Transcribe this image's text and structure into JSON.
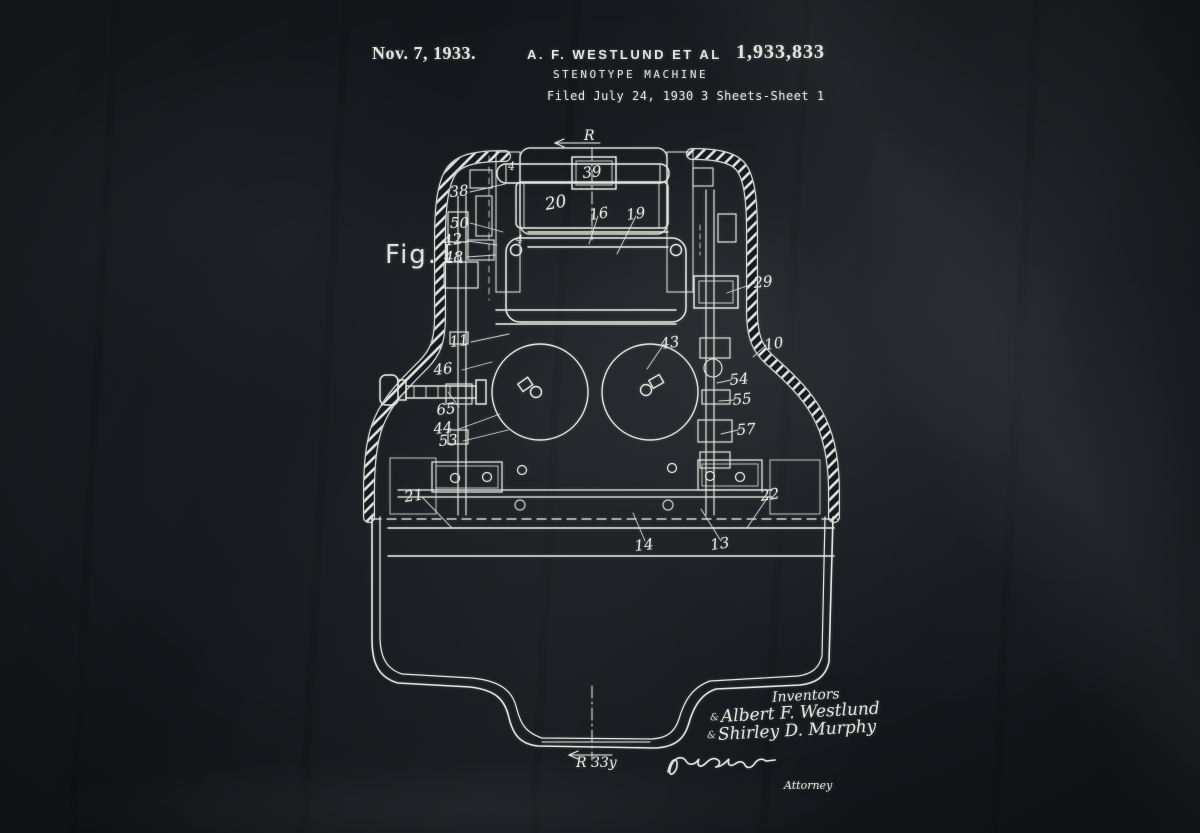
{
  "page": {
    "background": "#14171b",
    "chalk": "#e3e4de"
  },
  "header": {
    "date": "Nov. 7, 1933.",
    "author": "A. F. WESTLUND ET AL",
    "patent_number": "1,933,833",
    "title": "STENOTYPE MACHINE",
    "filed": "Filed July 24, 1930",
    "sheets": "3 Sheets-Sheet 1"
  },
  "figure": {
    "name": "Fig.1.",
    "section_top": "R",
    "section_bottom": "R 33y",
    "parts": {
      "p4": "4",
      "p10": "10",
      "p11": "11",
      "p13": "13",
      "p14": "14",
      "p16": "16",
      "p19": "19",
      "p20": "20",
      "p21": "21",
      "p22": "22",
      "p29": "29",
      "p38": "38",
      "p39": "39",
      "p42": "42",
      "p43": "43",
      "p44": "44",
      "p46": "46",
      "p48": "48",
      "p50": "50",
      "p53": "53",
      "p54": "54",
      "p55": "55",
      "p57": "57",
      "p65": "65"
    }
  },
  "signatures": {
    "inventors_label": "Inventors",
    "mark": "&",
    "inventor_1": "Albert F. Westlund",
    "inventor_2": "Shirley D. Murphy",
    "attorney_label": "Attorney"
  }
}
